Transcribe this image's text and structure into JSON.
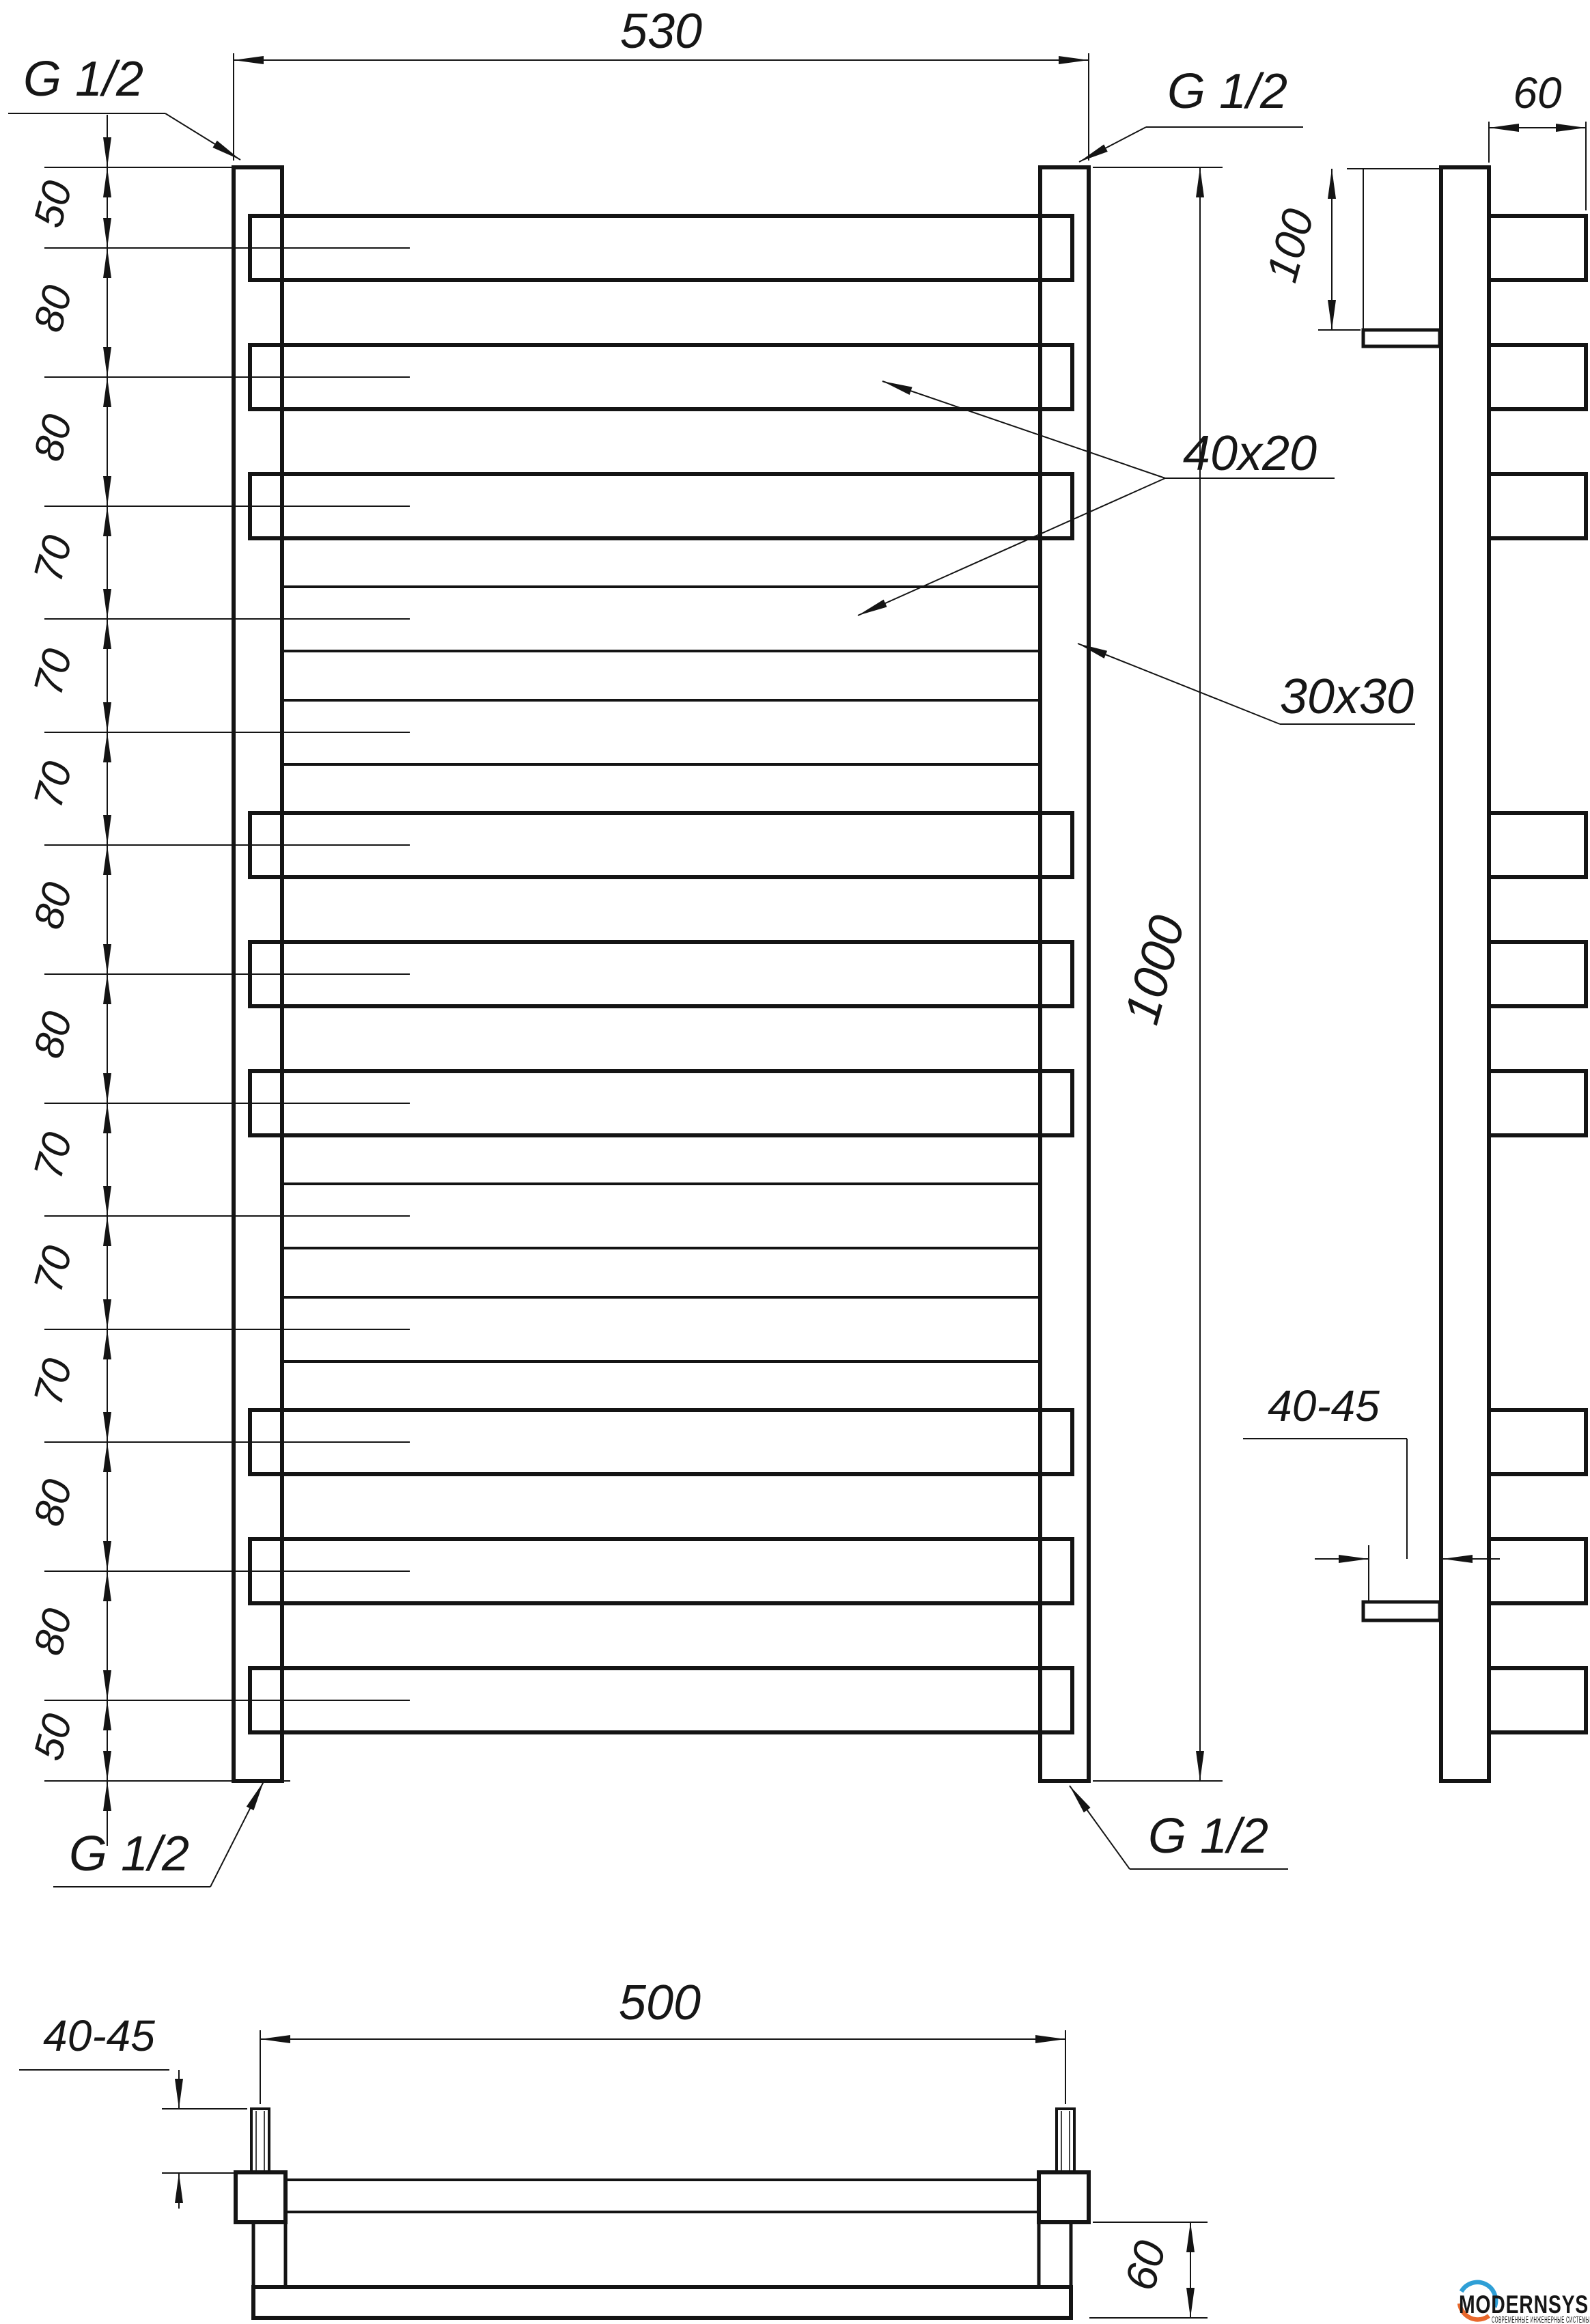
{
  "drawing": {
    "kind": "technical-drawing",
    "labels": {
      "thread": "G 1/2",
      "overall_width": "530",
      "overall_height": "1000",
      "bar_length": "500",
      "bar_profile": "40x20",
      "rail_profile": "30x30",
      "bracket_top_offset": "100",
      "bar_depth": "60",
      "wall_clearance": "40-45"
    },
    "chain_spacings": [
      "50",
      "80",
      "80",
      "70",
      "70",
      "70",
      "80",
      "80",
      "70",
      "70",
      "70",
      "80",
      "80",
      "50"
    ],
    "logo": {
      "name": "MODERNSYS",
      "tagline": "СОВРЕМЕННЫЕ  ИНЖЕНЕРНЫЕ  СИСТЕМЫ",
      "accent_blue": "#2f9fd6",
      "accent_orange": "#e8682c",
      "text_color": "#3b3b3d"
    }
  }
}
